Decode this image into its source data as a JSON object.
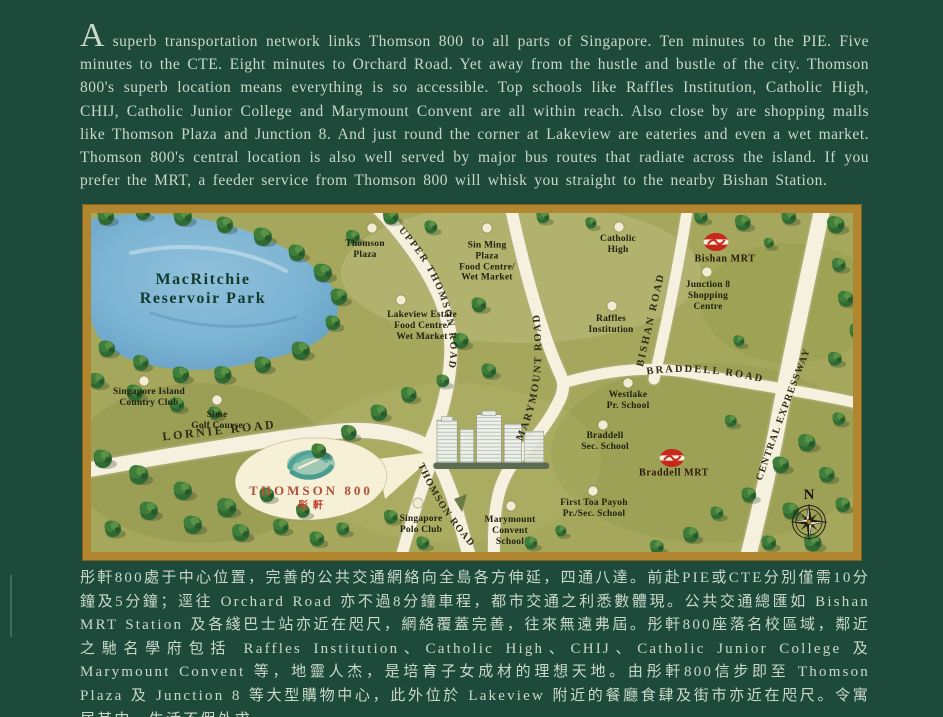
{
  "intro": {
    "dropcap": "A",
    "text": "superb transportation network links Thomson 800 to all parts of Singapore. Ten minutes to the PIE. Five minutes to the CTE. Eight minutes to Orchard Road. Yet away from the hustle and bustle of the city. Thomson 800's superb location means everything is so accessible. Top schools like Raffles Institution, Catholic High, CHIJ, Catholic Junior College and Marymount Convent are all within reach. Also close by are shopping malls like Thomson Plaza and Junction 8. And just round the corner at Lakeview are eateries and even a wet market. Thomson 800's central location is also well served by major bus routes that radiate across the island. If you prefer the MRT, a feeder service from Thomson 800 will whisk you straight to the nearby Bishan Station."
  },
  "chinese": {
    "text": "彤軒800處于中心位置，完善的公共交通網絡向全島各方伸延，四通八達。前赴PIE或CTE分別僅需10分鐘及5分鐘；逕往 Orchard Road 亦不過8分鐘車程，都市交通之利悉數體現。公共交通總匯如 Bishan MRT Station 及各綫巴士站亦近在咫尺，網絡覆蓋完善，往來無遠弗屆。彤軒800座落名校區域，鄰近之馳名學府包括 Raffles Institution、Catholic High、CHIJ、Catholic Junior College 及 Marymount Convent 等，地靈人杰，是培育子女成材的理想天地。由彤軒800信步即至 Thomson Plaza 及 Junction 8 等大型購物中心，此外位於 Lakeview 附近的餐廳食肆及街市亦近在咫尺。令寓居其中，生活不假外求。"
  },
  "map": {
    "park_label": "MacRitchie\nReservoir Park",
    "compass_n": "N",
    "logo": {
      "title": "THOMSON 800",
      "subtitle": "彤軒"
    },
    "roads": [
      {
        "name": "UPPER THOMSON ROAD"
      },
      {
        "name": "THOMSON ROAD"
      },
      {
        "name": "LORNIE ROAD"
      },
      {
        "name": "MARYMOUNT ROAD"
      },
      {
        "name": "BISHAN ROAD"
      },
      {
        "name": "BRADDELL ROAD"
      },
      {
        "name": "CENTRAL EXPRESSWAY"
      }
    ],
    "mrt_stations": [
      {
        "name": "Bishan MRT"
      },
      {
        "name": "Braddell MRT"
      }
    ],
    "places": [
      {
        "name": "Thomson\nPlaza"
      },
      {
        "name": "Sin Ming\nPlaza\nFood Centre/\nWet Market"
      },
      {
        "name": "Lakeview Estate\nFood Centre/\nWet Market"
      },
      {
        "name": "Catholic\nHigh"
      },
      {
        "name": "Junction 8\nShopping\nCentre"
      },
      {
        "name": "Raffles\nInstitution"
      },
      {
        "name": "Singapore Island\nCountry Club"
      },
      {
        "name": "Sime\nGolf Course"
      },
      {
        "name": "Westlake\nPr. School"
      },
      {
        "name": "Braddell\nSec. School"
      },
      {
        "name": "First Toa Payoh\nPr./Sec. School"
      },
      {
        "name": "Marymount\nConvent\nSchool"
      },
      {
        "name": "Singapore\nPolo Club"
      }
    ],
    "colors": {
      "page_background": "#1d4a3b",
      "body_text": "#c9d8ca",
      "map_border_gold": "#b2862e",
      "land": "#a5a75d",
      "lake": "#7cb4d3",
      "road": "#f5f1de",
      "mrt_red": "#c8281c",
      "logo_teal": "#4fa295",
      "logo_red": "#c23a28"
    }
  }
}
